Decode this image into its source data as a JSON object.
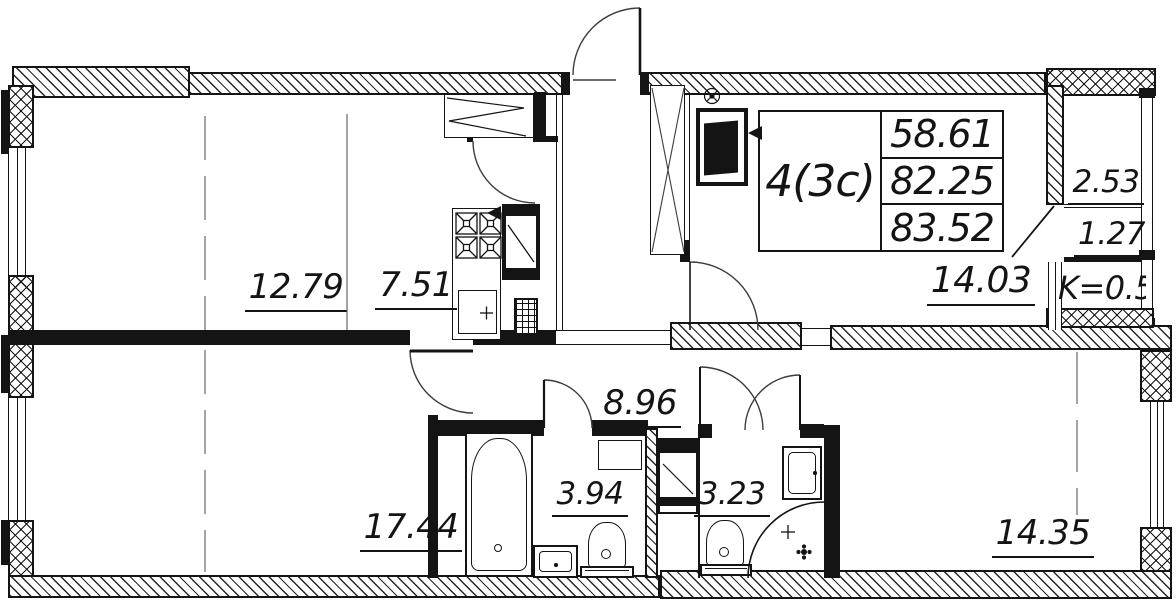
{
  "plan": {
    "title": "apartment floor plan",
    "title_block": {
      "unit_type": "4(3c)",
      "area_living": "58.61",
      "area_main": "82.25",
      "area_total": "83.52"
    },
    "rooms": {
      "bedroom_top_left": "12.79",
      "kitchen": "7.51",
      "room_top_right": "14.03",
      "hallway": "8.96",
      "room_bottom_left": "17.44",
      "bathroom_left": "3.94",
      "bathroom_right": "3.23",
      "room_bottom_right": "14.35"
    },
    "balcony": {
      "area_full": "2.53",
      "area_reduced": "1.27",
      "coefficient": "K=0.5"
    },
    "fixtures": [
      "stove",
      "kitchen-sink",
      "fridge",
      "vent-box",
      "entry-wardrobe",
      "duct-shaft",
      "hall-wardrobe",
      "vent-fan",
      "bathtub",
      "washbasin",
      "toilet",
      "washing-machine",
      "water-heater",
      "corner-shower",
      "shower-drain"
    ]
  },
  "colors": {
    "line": "#141414",
    "background": "#ffffff"
  }
}
